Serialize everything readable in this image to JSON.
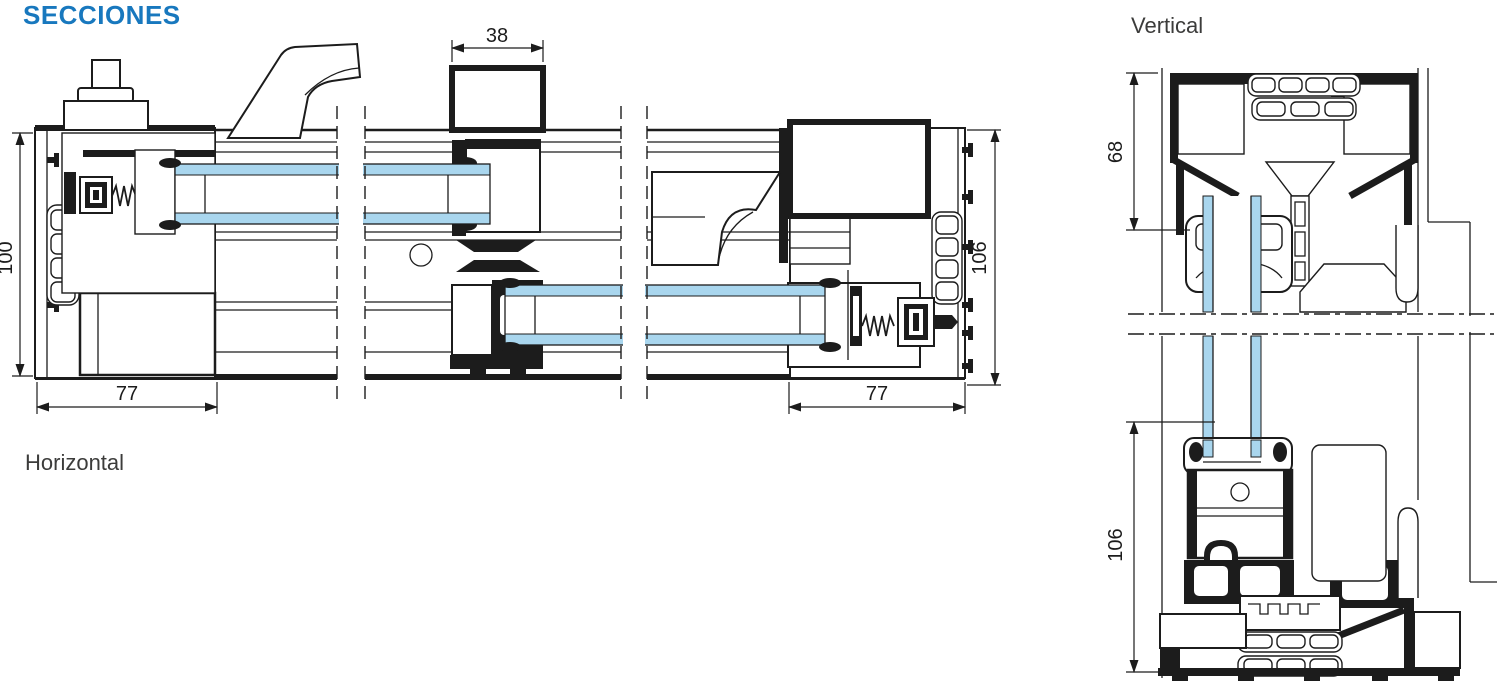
{
  "page": {
    "title": "SECCIONES"
  },
  "sections": {
    "horizontal": {
      "label": "Horizontal",
      "dimensions": {
        "interlock_width": "38",
        "frame_depth_left": "100",
        "frame_depth_right": "106",
        "jamb_width_left": "77",
        "jamb_width_right": "77"
      }
    },
    "vertical": {
      "label": "Vertical",
      "dimensions": {
        "head_height": "68",
        "sill_height": "106"
      }
    }
  },
  "colors": {
    "accent": "#1878BE",
    "glass": "#A9D6EE",
    "line": "#1C1C1C",
    "label": "#3C3C3B"
  }
}
